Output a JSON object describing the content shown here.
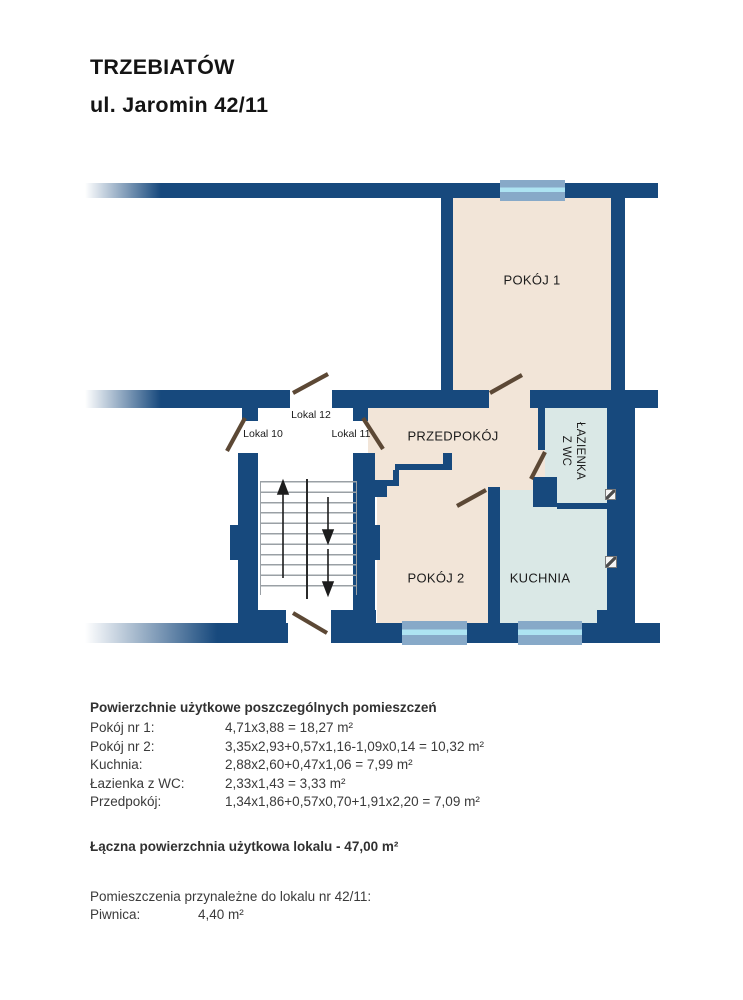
{
  "header": {
    "city": "TRZEBIATÓW",
    "address": "ul. Jaromin 42/11"
  },
  "plan": {
    "rooms": {
      "pokoj1": "POKÓJ 1",
      "pokoj2": "POKÓJ 2",
      "kuchnia": "KUCHNIA",
      "przedpokoj": "PRZEDPOKÓJ",
      "lazienka_line1": "ŁAZIENKA",
      "lazienka_line2": "Z WC"
    },
    "units": {
      "lokal10": "Lokal 10",
      "lokal11": "Lokal 11",
      "lokal12": "Lokal 12"
    },
    "colors": {
      "wall_navy": "#17497D",
      "room_beige": "#F2E5D8",
      "room_blue": "#DAE8E6",
      "window_frame": "#87A9C8",
      "window_glass": "#ADE3F2",
      "door_leaf": "#5C4835"
    }
  },
  "areas": {
    "heading": "Powierzchnie użytkowe poszczególnych pomieszczeń",
    "rows": [
      {
        "label": "Pokój nr 1:",
        "value": "4,71x3,88 = 18,27 m²"
      },
      {
        "label": "Pokój nr 2:",
        "value": "3,35x2,93+0,57x1,16-1,09x0,14 = 10,32 m²"
      },
      {
        "label": "Kuchnia:",
        "value": "2,88x2,60+0,47x1,06 = 7,99 m²"
      },
      {
        "label": "Łazienka z WC:",
        "value": "2,33x1,43 = 3,33 m²"
      },
      {
        "label": "Przedpokój:",
        "value": "1,34x1,86+0,57x0,70+1,91x2,20 = 7,09 m²"
      }
    ],
    "total": "Łączna powierzchnia użytkowa lokalu - 47,00 m²",
    "ancillary_heading": "Pomieszczenia przynależne do lokalu nr 42/11:",
    "ancillary_rows": [
      {
        "label": "Piwnica:",
        "value": "4,40 m²"
      }
    ]
  }
}
